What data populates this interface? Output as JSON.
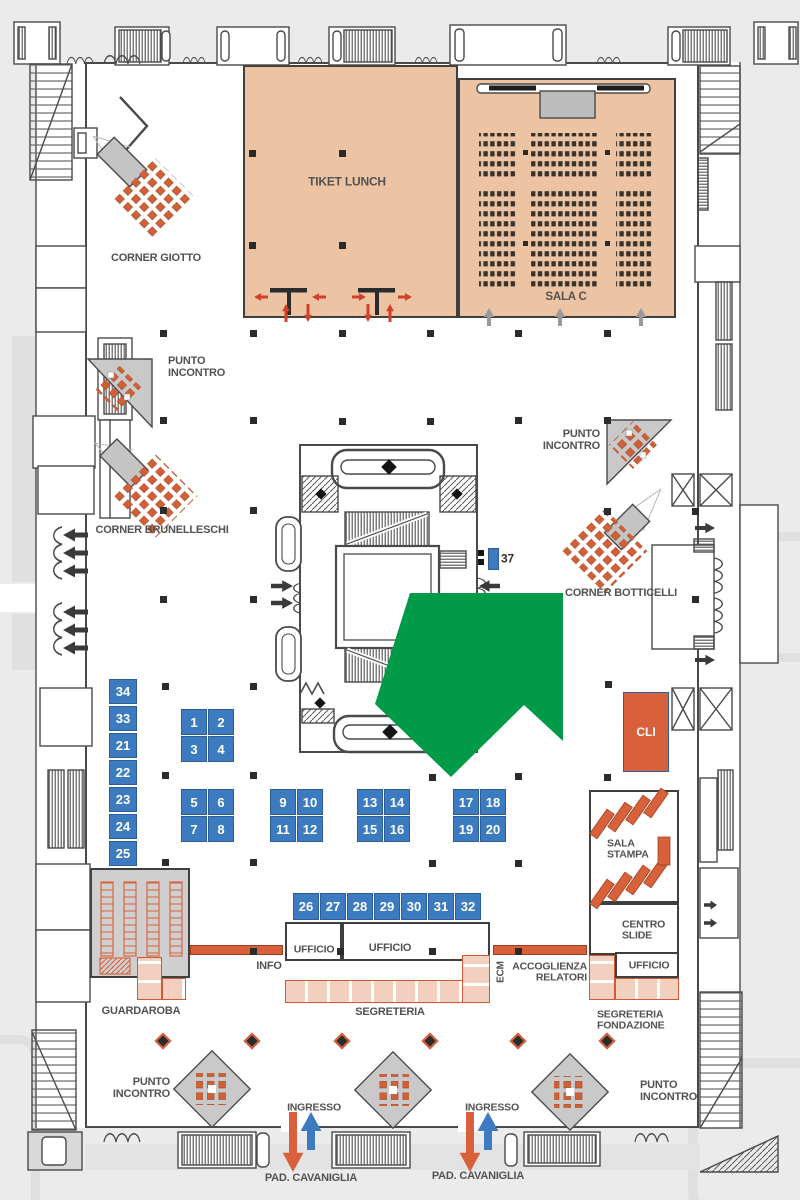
{
  "palette": {
    "wall": "#4a4a4a",
    "peach": "#edc4a3",
    "blue_booth": "#3c7bbf",
    "orange": "#d8613b",
    "salmon": "#f3cfc0",
    "kiosk_gray": "#c9c9c9",
    "highlight_green": "#009a49",
    "red_arrow": "#d2402a",
    "entry_blue": "#3d7abf",
    "label": "#525252"
  },
  "labels": [
    {
      "id": "tiket-lunch",
      "text": "TIKET LUNCH",
      "x": 347,
      "y": 182,
      "size": 12
    },
    {
      "id": "sala-c",
      "text": "SALA C",
      "x": 566,
      "y": 297,
      "size": 11.5
    },
    {
      "id": "corner-giotto",
      "text": "CORNER GIOTTO",
      "x": 156,
      "y": 259,
      "size": 11
    },
    {
      "id": "punto-incontro-1",
      "text": "PUNTO\nINCONTRO",
      "x": 168,
      "y": 368,
      "size": 11,
      "anchor": "left"
    },
    {
      "id": "corner-brunelleschi",
      "text": "CORNER BRUNELLESCHI",
      "x": 162,
      "y": 531,
      "size": 11
    },
    {
      "id": "punto-incontro-2",
      "text": "PUNTO\nINCONTRO",
      "x": 600,
      "y": 441,
      "size": 11,
      "anchor": "right"
    },
    {
      "id": "corner-botticelli",
      "text": "CORNER BOTTICELLI",
      "x": 621,
      "y": 594,
      "size": 11
    },
    {
      "id": "booth-37-number",
      "text": "37",
      "x": 501,
      "y": 559,
      "size": 12,
      "anchor": "left",
      "color": "#333333"
    },
    {
      "id": "sala-stampa",
      "text": "SALA\nSTAMPA",
      "x": 607,
      "y": 850,
      "size": 10.5,
      "anchor": "left"
    },
    {
      "id": "centro-slide",
      "text": "CENTRO\nSLIDE",
      "x": 622,
      "y": 931,
      "size": 10.5,
      "anchor": "left"
    },
    {
      "id": "ufficio-right",
      "text": "UFFICIO",
      "x": 649,
      "y": 966,
      "size": 10.5
    },
    {
      "id": "segreteria-fondazione",
      "text": "SEGRETERIA\nFONDAZIONE",
      "x": 597,
      "y": 1021,
      "size": 10.5,
      "anchor": "left"
    },
    {
      "id": "accoglienza-relatori",
      "text": "ACCOGLIENZA\nRELATORI",
      "x": 587,
      "y": 973,
      "size": 10.5,
      "anchor": "right"
    },
    {
      "id": "ecm",
      "text": "ECM",
      "x": 502,
      "y": 972,
      "size": 10,
      "vertical": true
    },
    {
      "id": "info",
      "text": "INFO",
      "x": 269,
      "y": 967,
      "size": 11
    },
    {
      "id": "ufficio-small",
      "text": "UFFICIO",
      "x": 314,
      "y": 950,
      "size": 10.5
    },
    {
      "id": "ufficio-large",
      "text": "UFFICIO",
      "x": 390,
      "y": 949,
      "size": 11
    },
    {
      "id": "segreteria",
      "text": "SEGRETERIA",
      "x": 390,
      "y": 1013,
      "size": 11
    },
    {
      "id": "guardaroba",
      "text": "GUARDAROBA",
      "x": 141,
      "y": 1012,
      "size": 11
    },
    {
      "id": "punto-incontro-3",
      "text": "PUNTO\nINCONTRO",
      "x": 170,
      "y": 1089,
      "size": 11,
      "anchor": "right"
    },
    {
      "id": "punto-incontro-4",
      "text": "PUNTO\nINCONTRO",
      "x": 640,
      "y": 1092,
      "size": 11,
      "anchor": "left"
    },
    {
      "id": "ingresso-1",
      "text": "INGRESSO",
      "x": 314,
      "y": 1108,
      "size": 10.5
    },
    {
      "id": "ingresso-2",
      "text": "INGRESSO",
      "x": 492,
      "y": 1108,
      "size": 10.5
    },
    {
      "id": "pad-cavaniglia-1",
      "text": "PAD. CAVANIGLIA",
      "x": 311,
      "y": 1179,
      "size": 11
    },
    {
      "id": "pad-cavaniglia-2",
      "text": "PAD. CAVANIGLIA",
      "x": 478,
      "y": 1177,
      "size": 11
    }
  ],
  "rooms": [
    {
      "name": "tiket-lunch",
      "x": 243,
      "y": 65,
      "w": 215,
      "h": 253,
      "fill": "#edc4a3",
      "sw": 2.5
    },
    {
      "name": "sala-c",
      "x": 458,
      "y": 78,
      "w": 218,
      "h": 240,
      "fill": "#edc4a3",
      "sw": 2.5
    },
    {
      "name": "guardaroba",
      "x": 90,
      "y": 868,
      "w": 100,
      "h": 110,
      "fill": "#cfcfcf",
      "sw": 2
    },
    {
      "name": "sala-stampa",
      "x": 589,
      "y": 790,
      "w": 90,
      "h": 113,
      "fill": "#ffffff",
      "sw": 2
    },
    {
      "name": "centro-slide",
      "x": 589,
      "y": 903,
      "w": 90,
      "h": 52,
      "fill": "#ffffff",
      "sw": 2
    },
    {
      "name": "ufficio-right",
      "x": 615,
      "y": 952,
      "w": 64,
      "h": 26,
      "fill": "#ffffff",
      "sw": 2
    },
    {
      "name": "ufficio-small",
      "x": 285,
      "y": 922,
      "w": 57,
      "h": 39,
      "fill": "#ffffff",
      "sw": 2
    },
    {
      "name": "ufficio-large",
      "x": 342,
      "y": 922,
      "w": 148,
      "h": 39,
      "fill": "#ffffff",
      "sw": 2
    }
  ],
  "booths": [
    {
      "n": "1",
      "x": 181,
      "y": 709
    },
    {
      "n": "2",
      "x": 208,
      "y": 709
    },
    {
      "n": "3",
      "x": 181,
      "y": 736
    },
    {
      "n": "4",
      "x": 208,
      "y": 736
    },
    {
      "n": "5",
      "x": 181,
      "y": 789
    },
    {
      "n": "6",
      "x": 208,
      "y": 789
    },
    {
      "n": "7",
      "x": 181,
      "y": 816
    },
    {
      "n": "8",
      "x": 208,
      "y": 816
    },
    {
      "n": "9",
      "x": 270,
      "y": 789
    },
    {
      "n": "10",
      "x": 297,
      "y": 789
    },
    {
      "n": "11",
      "x": 270,
      "y": 816
    },
    {
      "n": "12",
      "x": 297,
      "y": 816
    },
    {
      "n": "13",
      "x": 357,
      "y": 789
    },
    {
      "n": "14",
      "x": 384,
      "y": 789
    },
    {
      "n": "15",
      "x": 357,
      "y": 816
    },
    {
      "n": "16",
      "x": 384,
      "y": 816
    },
    {
      "n": "17",
      "x": 453,
      "y": 789
    },
    {
      "n": "18",
      "x": 480,
      "y": 789
    },
    {
      "n": "19",
      "x": 453,
      "y": 816
    },
    {
      "n": "20",
      "x": 480,
      "y": 816
    },
    {
      "n": "34",
      "x": 109,
      "y": 679,
      "w": 28,
      "h": 25
    },
    {
      "n": "33",
      "x": 109,
      "y": 706,
      "w": 28,
      "h": 25
    },
    {
      "n": "21",
      "x": 109,
      "y": 733,
      "w": 28,
      "h": 25
    },
    {
      "n": "22",
      "x": 109,
      "y": 760,
      "w": 28,
      "h": 25
    },
    {
      "n": "23",
      "x": 109,
      "y": 787,
      "w": 28,
      "h": 25
    },
    {
      "n": "24",
      "x": 109,
      "y": 814,
      "w": 28,
      "h": 25
    },
    {
      "n": "25",
      "x": 109,
      "y": 841,
      "w": 28,
      "h": 25
    },
    {
      "n": "26",
      "x": 293,
      "y": 893,
      "w": 26,
      "h": 27
    },
    {
      "n": "27",
      "x": 320,
      "y": 893,
      "w": 26,
      "h": 27
    },
    {
      "n": "28",
      "x": 347,
      "y": 893,
      "w": 26,
      "h": 27
    },
    {
      "n": "29",
      "x": 374,
      "y": 893,
      "w": 26,
      "h": 27
    },
    {
      "n": "30",
      "x": 401,
      "y": 893,
      "w": 26,
      "h": 27
    },
    {
      "n": "31",
      "x": 428,
      "y": 893,
      "w": 26,
      "h": 27
    },
    {
      "n": "32",
      "x": 455,
      "y": 893,
      "w": 26,
      "h": 27
    },
    {
      "n": "37",
      "x": 488,
      "y": 548,
      "w": 11,
      "h": 22,
      "blank": true
    },
    {
      "n": "CLI",
      "x": 623,
      "y": 692,
      "w": 46,
      "h": 80,
      "fill": "#d8613b",
      "fs": 12
    }
  ],
  "counters": [
    {
      "name": "segreteria",
      "x": 285,
      "y": 980,
      "w": 205,
      "h": 23,
      "dir": "h"
    },
    {
      "name": "segreteria-fondazione",
      "x": 615,
      "y": 978,
      "w": 64,
      "h": 22,
      "dir": "h"
    },
    {
      "name": "fondazione-side",
      "x": 589,
      "y": 955,
      "w": 26,
      "h": 45,
      "dir": "v"
    },
    {
      "name": "accoglienza",
      "x": 462,
      "y": 955,
      "w": 28,
      "h": 48,
      "dir": "v"
    },
    {
      "name": "guardaroba-a",
      "x": 137,
      "y": 957,
      "w": 25,
      "h": 43,
      "dir": "v"
    },
    {
      "name": "guardaroba-b",
      "x": 162,
      "y": 978,
      "w": 24,
      "h": 22,
      "dir": "h"
    },
    {
      "name": "info-desk",
      "x": 190,
      "y": 945,
      "w": 93,
      "h": 10,
      "dir": "solid"
    },
    {
      "name": "ecm-desk",
      "x": 493,
      "y": 945,
      "w": 94,
      "h": 10,
      "dir": "solid"
    }
  ],
  "columns": [
    [
      252,
      153
    ],
    [
      342,
      153
    ],
    [
      252,
      245
    ],
    [
      342,
      245
    ],
    [
      163,
      333
    ],
    [
      253,
      333
    ],
    [
      342,
      333
    ],
    [
      430,
      333
    ],
    [
      518,
      333
    ],
    [
      607,
      333
    ],
    [
      163,
      420
    ],
    [
      253,
      420
    ],
    [
      342,
      421
    ],
    [
      430,
      421
    ],
    [
      518,
      420
    ],
    [
      607,
      420
    ],
    [
      163,
      510
    ],
    [
      253,
      510
    ],
    [
      607,
      511
    ],
    [
      695,
      511
    ],
    [
      163,
      599
    ],
    [
      253,
      599
    ],
    [
      695,
      599
    ],
    [
      165,
      686
    ],
    [
      253,
      686
    ],
    [
      608,
      684
    ],
    [
      165,
      775
    ],
    [
      253,
      775
    ],
    [
      432,
      777
    ],
    [
      518,
      776
    ],
    [
      607,
      777
    ],
    [
      165,
      862
    ],
    [
      253,
      862
    ],
    [
      432,
      863
    ],
    [
      518,
      863
    ],
    [
      253,
      951
    ],
    [
      340,
      951
    ],
    [
      432,
      951
    ],
    [
      518,
      951
    ]
  ],
  "column_markers": [
    [
      163,
      1041
    ],
    [
      252,
      1041
    ],
    [
      342,
      1041
    ],
    [
      430,
      1041
    ],
    [
      518,
      1041
    ],
    [
      607,
      1041
    ]
  ],
  "arrows": [
    {
      "name": "ingresso-1-out",
      "x": 293,
      "y": 1112,
      "dir": "down",
      "len": 60,
      "w": 8,
      "color": "#d8613b"
    },
    {
      "name": "ingresso-1-in",
      "x": 311,
      "y": 1150,
      "dir": "up",
      "len": 38,
      "w": 8,
      "color": "#3d7abf"
    },
    {
      "name": "ingresso-2-out",
      "x": 470,
      "y": 1112,
      "dir": "down",
      "len": 60,
      "w": 8,
      "color": "#d8613b"
    },
    {
      "name": "ingresso-2-in",
      "x": 488,
      "y": 1150,
      "dir": "up",
      "len": 38,
      "w": 8,
      "color": "#3d7abf"
    },
    {
      "name": "sala-c-entry-1",
      "x": 489,
      "y": 326,
      "dir": "up",
      "len": 18,
      "w": 4,
      "color": "#9a9a9a"
    },
    {
      "name": "sala-c-entry-2",
      "x": 560,
      "y": 326,
      "dir": "up",
      "len": 18,
      "w": 4,
      "color": "#9a9a9a"
    },
    {
      "name": "sala-c-entry-3",
      "x": 641,
      "y": 326,
      "dir": "up",
      "len": 18,
      "w": 4,
      "color": "#9a9a9a"
    },
    {
      "name": "exit-left-1",
      "x": 88,
      "y": 535,
      "dir": "left",
      "len": 25,
      "w": 5,
      "color": "#3a3a3a"
    },
    {
      "name": "exit-left-2",
      "x": 88,
      "y": 553,
      "dir": "left",
      "len": 25,
      "w": 5,
      "color": "#3a3a3a"
    },
    {
      "name": "exit-left-3",
      "x": 88,
      "y": 571,
      "dir": "left",
      "len": 25,
      "w": 5,
      "color": "#3a3a3a"
    },
    {
      "name": "exit-left-4",
      "x": 88,
      "y": 612,
      "dir": "left",
      "len": 25,
      "w": 5,
      "color": "#3a3a3a"
    },
    {
      "name": "exit-left-5",
      "x": 88,
      "y": 630,
      "dir": "left",
      "len": 25,
      "w": 5,
      "color": "#3a3a3a"
    },
    {
      "name": "exit-left-6",
      "x": 88,
      "y": 648,
      "dir": "left",
      "len": 25,
      "w": 5,
      "color": "#3a3a3a"
    },
    {
      "name": "atrium-in-1",
      "x": 271,
      "y": 586,
      "dir": "right",
      "len": 22,
      "w": 4.5,
      "color": "#3a3a3a"
    },
    {
      "name": "atrium-in-2",
      "x": 271,
      "y": 603,
      "dir": "right",
      "len": 22,
      "w": 4.5,
      "color": "#3a3a3a"
    },
    {
      "name": "atrium-in-3",
      "x": 500,
      "y": 586,
      "dir": "left",
      "len": 21,
      "w": 4.5,
      "color": "#3a3a3a"
    },
    {
      "name": "corridor-right-1",
      "x": 695,
      "y": 528,
      "dir": "right",
      "len": 20,
      "w": 4,
      "color": "#3a3a3a"
    },
    {
      "name": "corridor-right-2",
      "x": 695,
      "y": 660,
      "dir": "right",
      "len": 20,
      "w": 4,
      "color": "#3a3a3a"
    },
    {
      "name": "room-right-1",
      "x": 704,
      "y": 905,
      "dir": "right",
      "len": 13,
      "w": 3.5,
      "color": "#3a3a3a"
    },
    {
      "name": "room-right-2",
      "x": 704,
      "y": 923,
      "dir": "right",
      "len": 13,
      "w": 3.5,
      "color": "#3a3a3a"
    },
    {
      "name": "tiket-door-1",
      "x": 268,
      "y": 297,
      "dir": "left",
      "len": 14,
      "w": 3,
      "color": "#d2402a"
    },
    {
      "name": "tiket-door-2",
      "x": 326,
      "y": 297,
      "dir": "left",
      "len": 14,
      "w": 3,
      "color": "#d2402a"
    },
    {
      "name": "tiket-door-3",
      "x": 352,
      "y": 297,
      "dir": "right",
      "len": 14,
      "w": 3,
      "color": "#d2402a"
    },
    {
      "name": "tiket-door-4",
      "x": 398,
      "y": 297,
      "dir": "right",
      "len": 14,
      "w": 3,
      "color": "#d2402a"
    },
    {
      "name": "tiket-door-5",
      "x": 286,
      "y": 322,
      "dir": "up",
      "len": 18,
      "w": 3,
      "color": "#d2402a"
    },
    {
      "name": "tiket-door-6",
      "x": 308,
      "y": 304,
      "dir": "down",
      "len": 18,
      "w": 3,
      "color": "#d2402a"
    },
    {
      "name": "tiket-door-7",
      "x": 368,
      "y": 304,
      "dir": "down",
      "len": 18,
      "w": 3,
      "color": "#d2402a"
    },
    {
      "name": "tiket-door-8",
      "x": 390,
      "y": 322,
      "dir": "up",
      "len": 18,
      "w": 3,
      "color": "#d2402a"
    }
  ],
  "highlight_arrow": {
    "color": "#009a49",
    "points": "410,593 563,593 563,741 524,705 451,777 375,704"
  }
}
